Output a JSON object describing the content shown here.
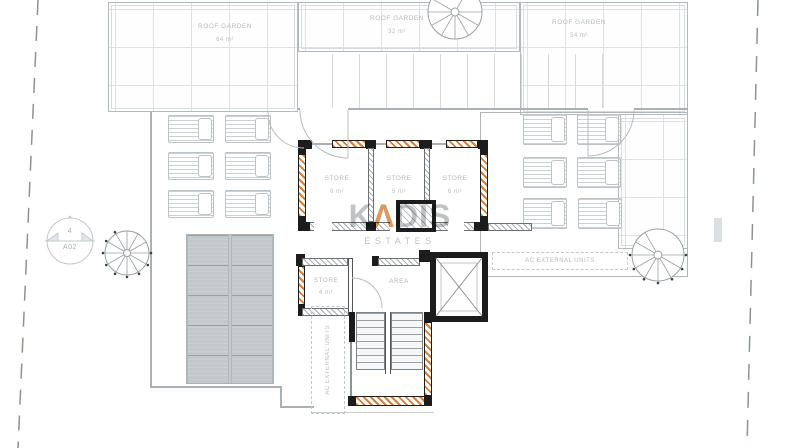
{
  "drawing": {
    "type": "roof-floor-plan"
  },
  "roof_gardens": [
    {
      "label": "ROOF GARDEN",
      "area": "64 m²"
    },
    {
      "label": "ROOF GARDEN",
      "area": "32 m²"
    },
    {
      "label": "ROOF GARDEN",
      "area": "54 m²"
    }
  ],
  "stores": [
    {
      "label": "STORE",
      "area": "6 m²"
    },
    {
      "label": "STORE",
      "area": "5 m²"
    },
    {
      "label": "STORE",
      "area": "6 m²"
    },
    {
      "label": "STORE",
      "area": "4 m²"
    }
  ],
  "area_room": {
    "label": "AREA"
  },
  "ac_units": {
    "right_label": "AC EXTERNAL UNITS",
    "left_label": "AC EXTERNAL UNITS"
  },
  "section_marker": {
    "number": "4",
    "sheet": "A02"
  },
  "watermark": {
    "part1": "K",
    "lambda": "Λ",
    "part2": "DIS",
    "subtitle": "ESTATES"
  },
  "colors": {
    "wall": "#1c1c1c",
    "insulation_hatch": "#d4803a",
    "line": "#aab0b5",
    "label": "#b4b9bd"
  }
}
